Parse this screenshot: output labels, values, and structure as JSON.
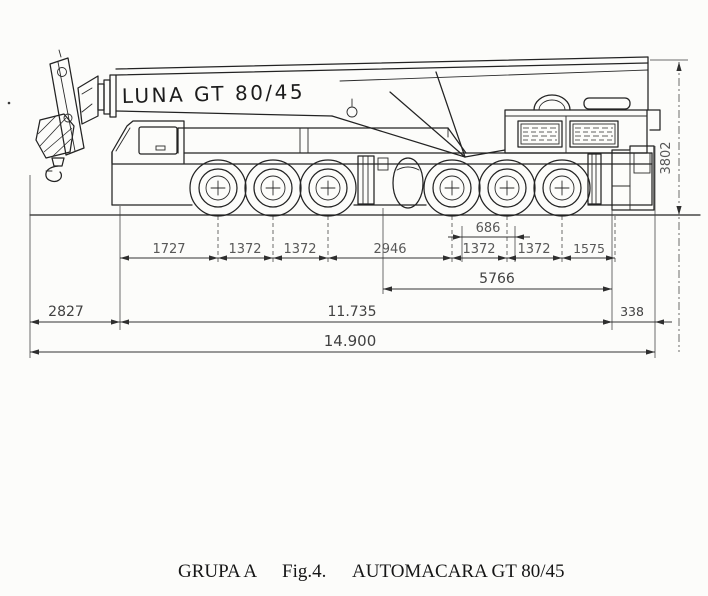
{
  "drawing": {
    "boom_label": "LUNA GT 80/45",
    "axle_dims": [
      "1727",
      "1372",
      "1372",
      "2946",
      "1372",
      "1372",
      "1575"
    ],
    "dim_track": "686",
    "dim_rear_group": "5766",
    "dim_front_overhang": "2827",
    "dim_chassis": "11.735",
    "dim_rear_overhang": "338",
    "dim_total_length": "14.900",
    "dim_height": "3802",
    "ink_color": "#232323",
    "paper_color": "#fcfcfa"
  },
  "caption": {
    "group_label": "GRUPA A",
    "figure_label": "Fig.4.",
    "title": "AUTOMACARA GT 80/45"
  }
}
